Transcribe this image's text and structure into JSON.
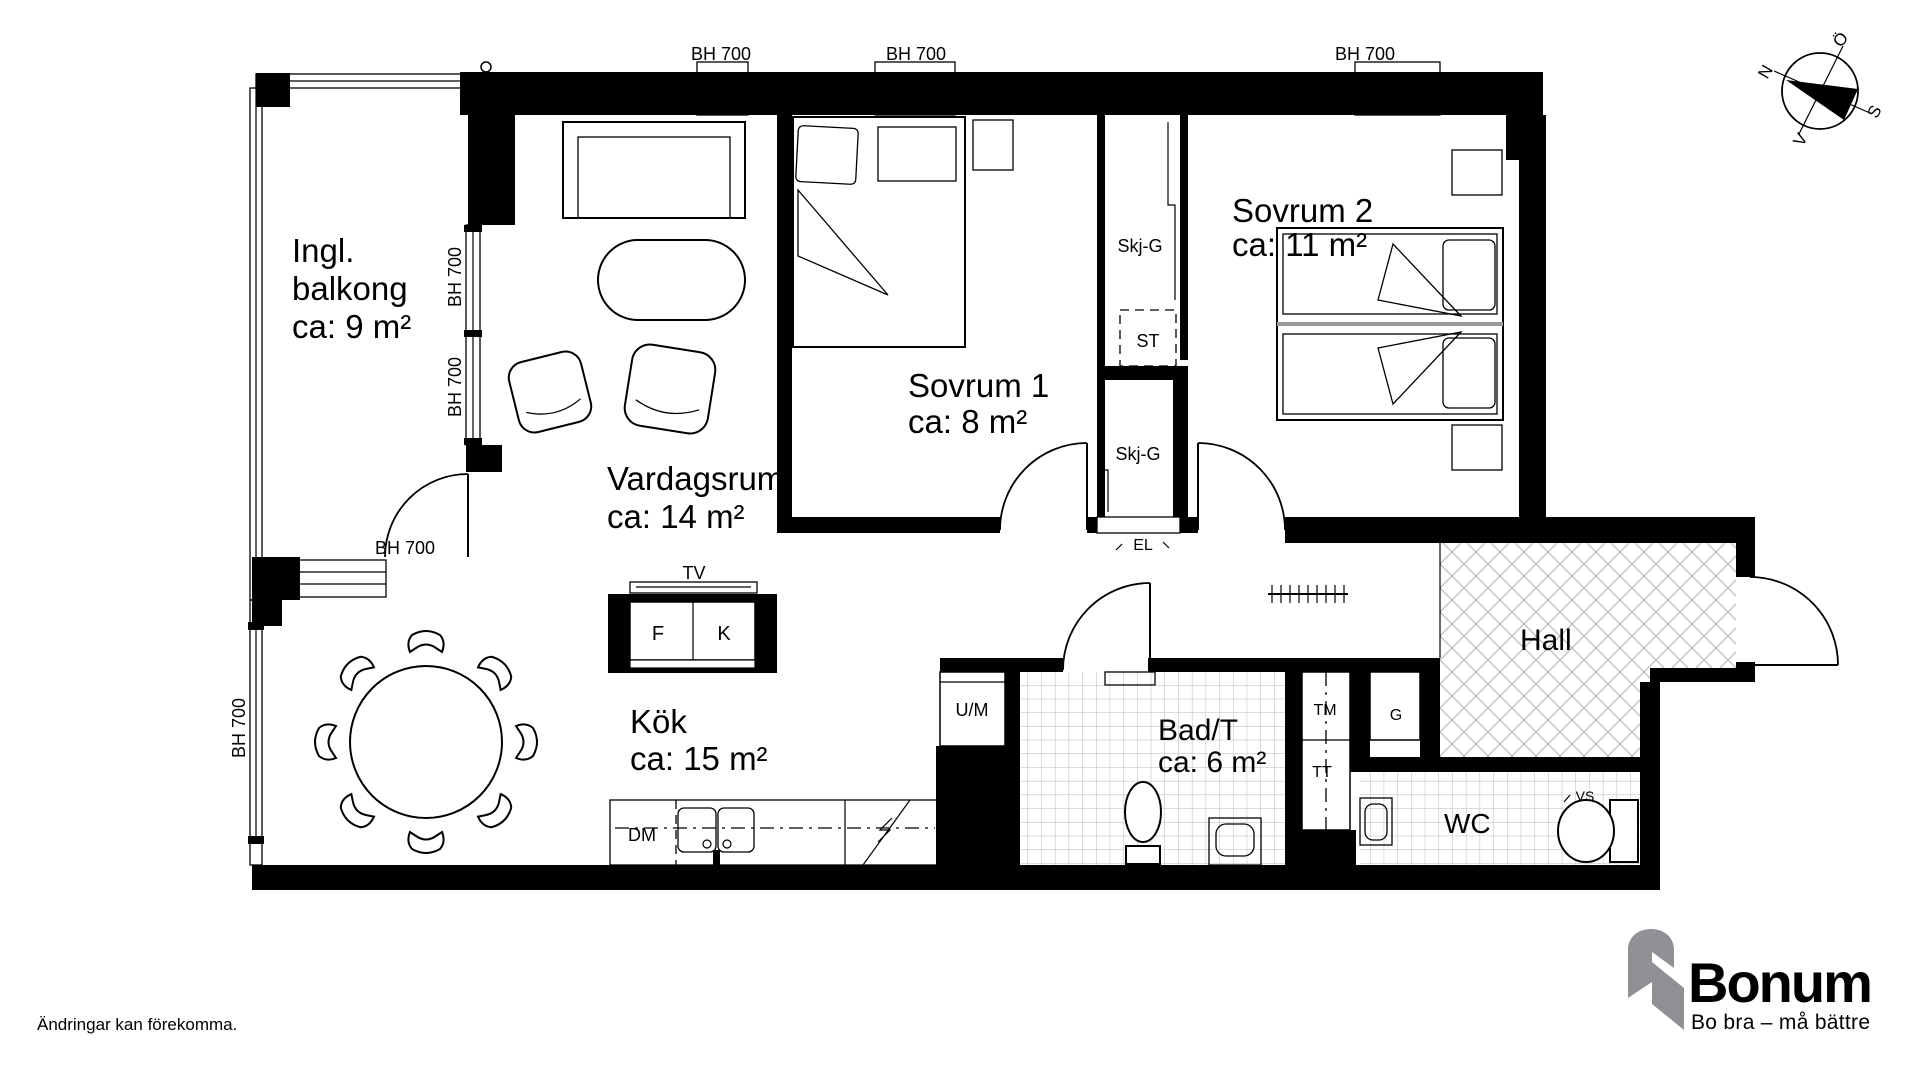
{
  "colors": {
    "wall": "#000000",
    "tile_line": "#b5b5b5",
    "brand_orange": "#F7A51F",
    "brand_gray": "#8F9194",
    "brand_dark": "#414042"
  },
  "rooms": {
    "balcony": {
      "line1": "Ingl.",
      "line2": "balkong",
      "area": "ca: 9 m²"
    },
    "living": {
      "name": "Vardagsrum",
      "area": "ca: 14 m²"
    },
    "bedroom1": {
      "name": "Sovrum 1",
      "area": "ca: 8 m²"
    },
    "bedroom2": {
      "name": "Sovrum 2",
      "area": "ca: 11 m²"
    },
    "kitchen": {
      "name": "Kök",
      "area": "ca: 15 m²"
    },
    "bath": {
      "name": "Bad/T",
      "area": "ca: 6 m²"
    },
    "hall": {
      "name": "Hall"
    },
    "wc": {
      "name": "WC"
    }
  },
  "fixtures": {
    "tv": "TV",
    "fridge": "F",
    "freezer": "K",
    "dishwasher": "DM",
    "washer_micro": "U/M",
    "sliding_wardrobe_upper": "Skj-G",
    "sliding_wardrobe_lower": "Skj-G",
    "st": "ST",
    "el": "EL",
    "washing_machine": "TM",
    "dryer": "TT",
    "wardrobe_g": "G",
    "vs": "VS"
  },
  "windows": {
    "sills": [
      "BH 700",
      "BH 700",
      "BH 700",
      "BH 700",
      "BH 700",
      "BH 700",
      "BH 700"
    ]
  },
  "compass": {
    "north": "N",
    "east": "Ö",
    "south": "S",
    "west": "V"
  },
  "branding": {
    "name": "Bonum",
    "tagline": "Bo bra – må bättre"
  },
  "disclaimer": "Ändringar kan förekomma."
}
